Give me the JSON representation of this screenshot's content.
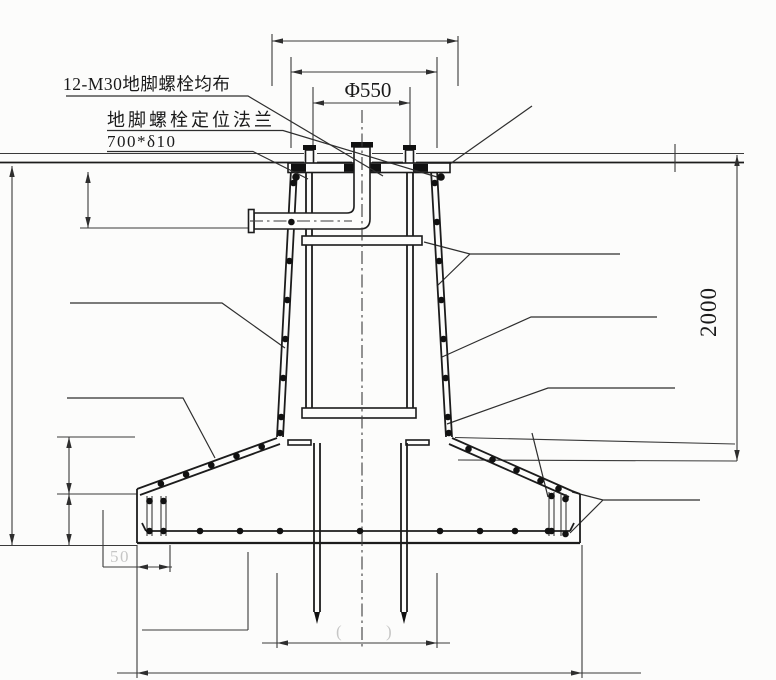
{
  "drawing": {
    "title": "anchor-bolt-foundation-section",
    "callouts": {
      "anchor_bolts": "12-M30地脚螺栓均布",
      "flange_line1": "地脚螺栓定位法兰",
      "flange_line2": "700*δ10"
    },
    "dimensions": {
      "bolt_circle": "Φ550",
      "foundation_depth": "2000",
      "edge_offset": "50",
      "erased_open": "(",
      "erased_close": ")"
    },
    "colors": {
      "line": "#1c1c1c",
      "dim_line": "#3a3a3a",
      "paper": "#fcfcfb"
    }
  }
}
